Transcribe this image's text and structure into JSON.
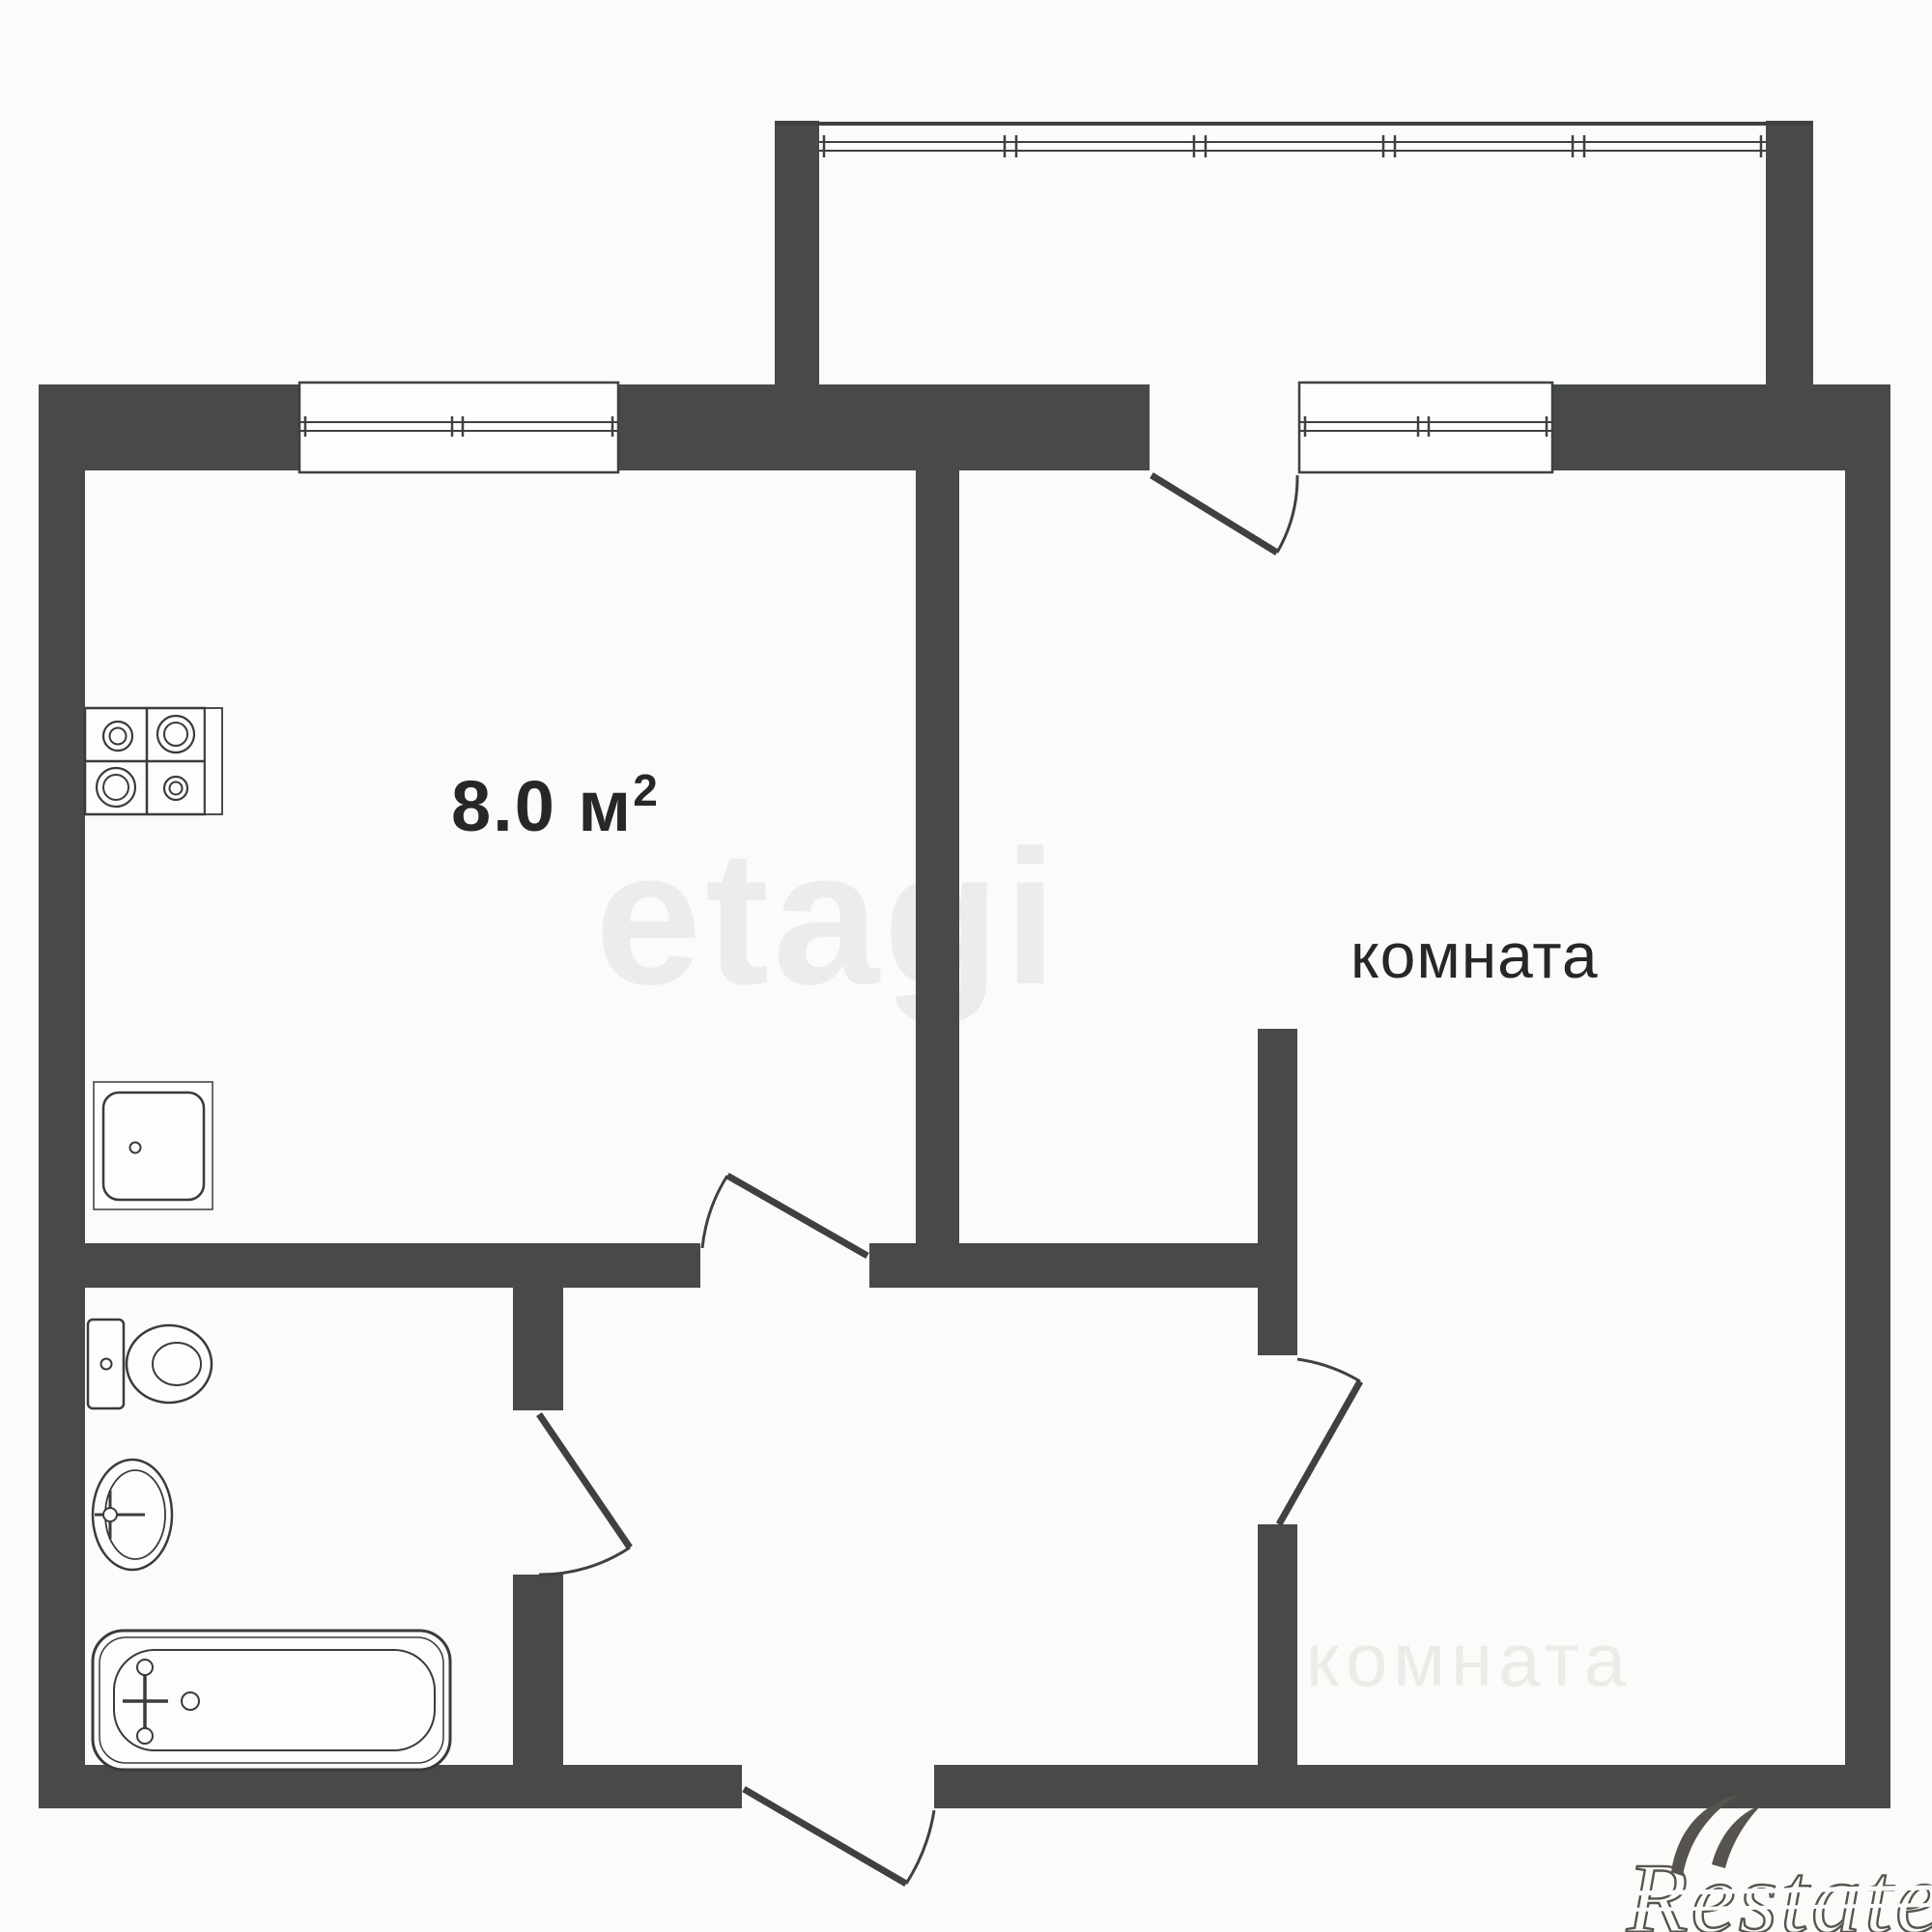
{
  "plan": {
    "colors": {
      "wall": "#474a46",
      "line": "#3f413e",
      "text": "#272727",
      "background": "#fbfbfa",
      "watermark_light": "#ecedea"
    },
    "rooms": {
      "kitchen": {
        "area_value": "8.0",
        "area_unit": " м",
        "area_sup": "2"
      },
      "living_room": {
        "label": "комната"
      }
    },
    "fixtures": [
      "stove",
      "kitchen-sink",
      "toilet",
      "washbasin",
      "bathtub"
    ],
    "watermarks": {
      "brand_center": "etagi",
      "brand_corner": "Restate",
      "ghost_label": "комната"
    }
  }
}
